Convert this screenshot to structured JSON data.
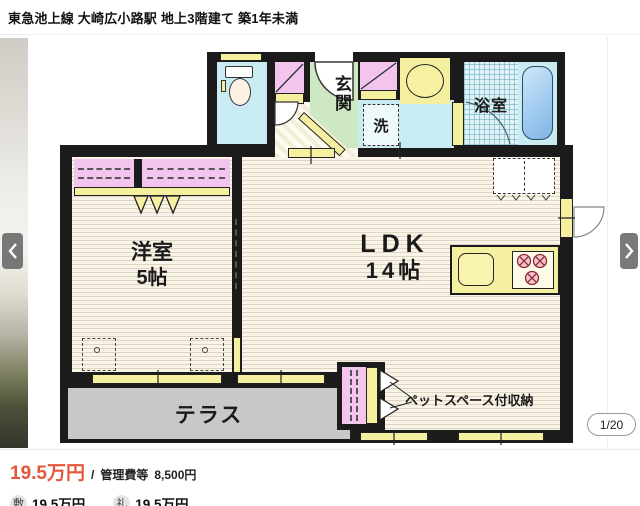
{
  "header": {
    "title": "東急池上線 大崎広小路駅 地上3階建て 築1年未満"
  },
  "gallery": {
    "page_indicator": "1/20"
  },
  "floor_plan": {
    "rooms": {
      "entrance": "玄関",
      "laundry": "洗",
      "bathroom": "浴室",
      "western_room_name": "洋室",
      "western_room_size": "5帖",
      "ldk_name": "LDK",
      "ldk_size": "14帖",
      "terrace": "テラス",
      "pet_storage": "ペットスペース付収納"
    }
  },
  "pricing": {
    "rent": "19.5万円",
    "separator": "/",
    "management_fee_label": "管理費等",
    "management_fee_value": "8,500円",
    "deposit_label": "敷",
    "deposit_value": "19.5万円",
    "key_money_label": "礼",
    "key_money_value": "19.5万円"
  },
  "colors": {
    "rent_accent": "#e4563a",
    "wall": "#1b1b1b",
    "room_floor": "#f9f4e7",
    "water_blue": "#c9ecf2",
    "closet_pink": "#f2c4ee",
    "fixture_yellow": "#f5f0a0",
    "entrance_green": "#cde8c3",
    "terrace_gray": "#c8c8c8"
  }
}
